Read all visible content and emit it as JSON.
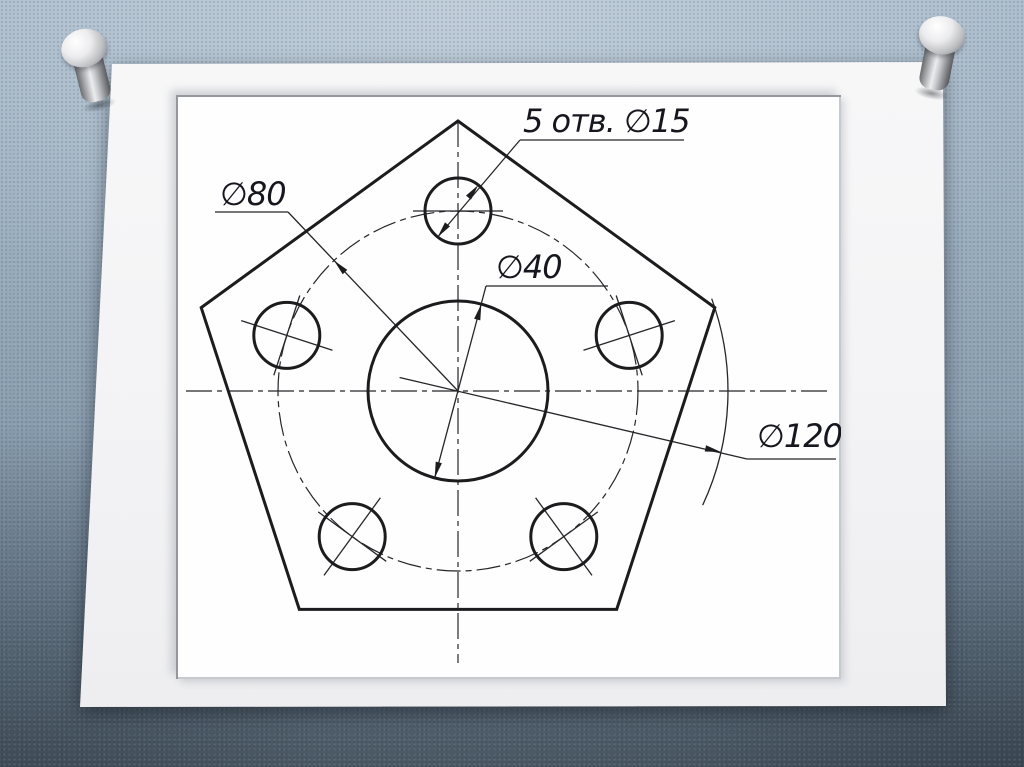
{
  "scene": {
    "description": "Engineering drawing slide pinned to a fabric board",
    "board_color": "#9cafc0",
    "slide_color": "#f3f3f5",
    "line_color": "#1c1c1e"
  },
  "pins": {
    "left_icon": "push-pin",
    "right_icon": "push-pin"
  },
  "drawing": {
    "labels": {
      "holes_note": "5 отв. ∅15",
      "bolt_circle_diameter": "∅80",
      "center_hole_diameter": "∅40",
      "circumscribed_diameter": "∅120"
    },
    "values": {
      "hole_count": 5,
      "hole_diameter_mm": 15,
      "bolt_circle_diameter_mm": 80,
      "center_hole_diameter_mm": 40,
      "circumscribed_diameter_mm": 120
    },
    "shape": "pentagon plate with central hole and 5 bolt holes"
  }
}
